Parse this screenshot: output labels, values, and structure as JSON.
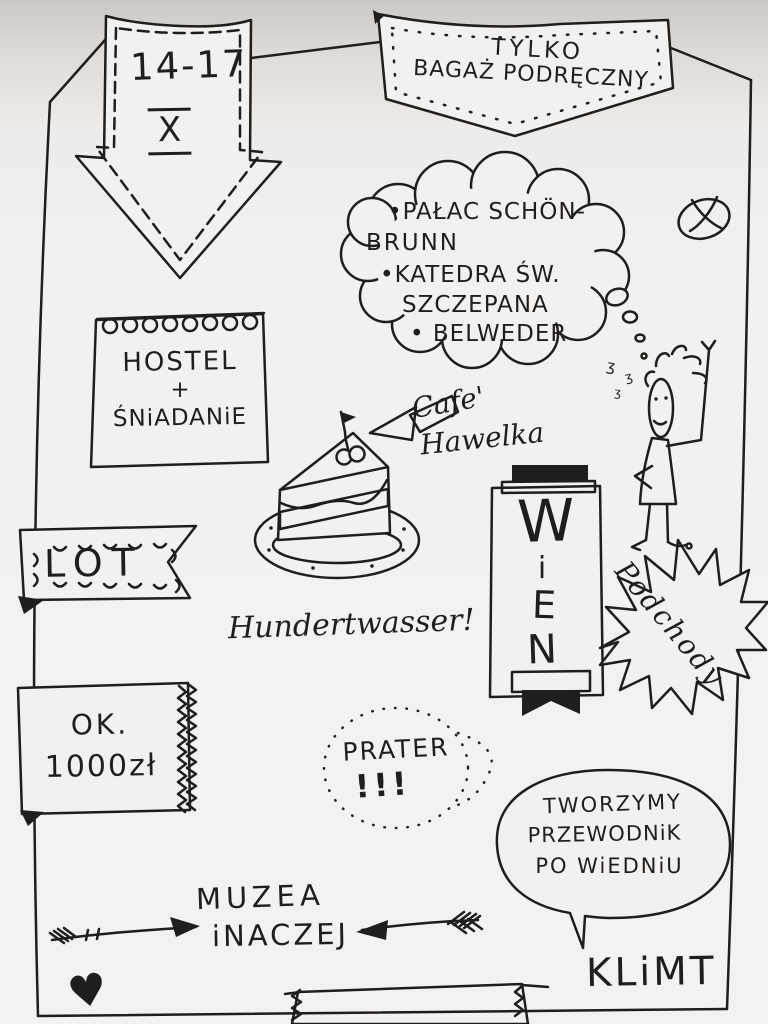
{
  "colors": {
    "ink": "#201e1c",
    "paper": "#f3f1ef"
  },
  "icons": {
    "heart_glyph": "♥",
    "squiggle_glyph": "ʒ"
  },
  "date_arrow": {
    "range": "14-17",
    "month_roman": "X"
  },
  "baggage_banner": {
    "line1": "TYLKO",
    "line2": "BAGAŻ PODRĘCZNY"
  },
  "sights_cloud": {
    "line1": "•PAŁAC SCHÖN-",
    "line2": "BRUNN",
    "line3": "•KATEDRA ŚW.",
    "line4": "SZCZEPANA",
    "line5": "• BELWEDER"
  },
  "notepad": {
    "line1": "HOSTEL",
    "line2": "+",
    "line3": "ŚNiADANiE"
  },
  "cafe_note": {
    "line1": "Cafe'",
    "line2": "Hawelka"
  },
  "wien_banner": {
    "letter1": "W",
    "letter2": "i",
    "letter3": "E",
    "letter4": "N"
  },
  "podchody": {
    "label": "Podchody"
  },
  "lot_flag": {
    "label": "LOT"
  },
  "hundertwasser": {
    "label": "Hundertwasser!"
  },
  "price_ticket": {
    "line1": "OK.",
    "line2": "1000zł"
  },
  "prater_bubble": {
    "line1": "PRATER",
    "line2": "!!!"
  },
  "speech_bubble": {
    "line1": "TWORZYMY",
    "line2": "PRZEWODNiK",
    "line3": "PO WiEDNiU"
  },
  "muzea_note": {
    "line1": "MUZEA",
    "line2": "iNACZEJ"
  },
  "klimt": {
    "label": "KLiMT"
  }
}
